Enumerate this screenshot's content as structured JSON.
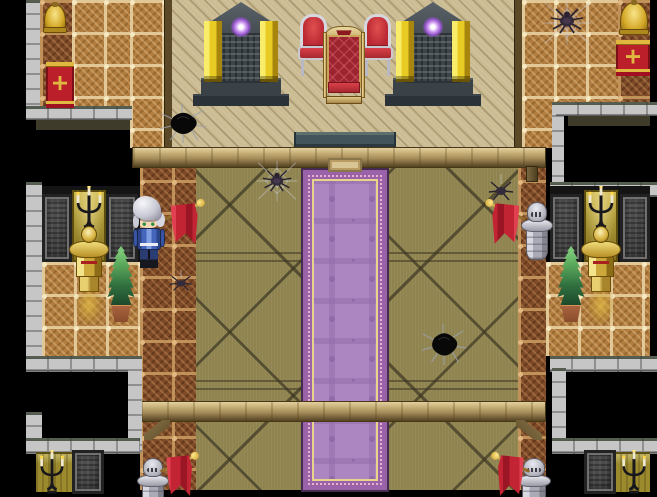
{
  "meta": {
    "viewport": {
      "width": 657,
      "height": 497
    }
  },
  "palette": {
    "void": "#000000",
    "tanFloor": "#cbbc94",
    "tileBase": "#b07c3f",
    "tileFrame": "#e3c897",
    "tileDarkBase": "#7f4a28",
    "tileDarkFrame": "#c1915a",
    "olive": "#8f844f",
    "oliveLine": "#3c3622",
    "stone": "#c6c6c6",
    "stoneLine": "#8f8f8f",
    "stoneTop": "#3d4537",
    "darkbg": "#141414",
    "shadow": "#3f3b2a",
    "oliveWall": "#9c8a2e",
    "carpetField": "#ab86c0",
    "carpetMotif": "#8f6aa8",
    "carpetBand": "#9a62a8",
    "carpetGold": "#e8d48a",
    "carpetEdge": "#452a52",
    "carpetPink": "#e8b2cc",
    "beamFace": "#b89f6a",
    "flagRed": "#c32433",
    "bannerRed": "#bb1f2a",
    "bannerGold": "#e0b840",
    "gold": "#d4b23c",
    "goldLight": "#f5e58a",
    "goldDark": "#8a6a14",
    "silver": "#b9b9c4",
    "silverLight": "#e9e9f0",
    "silverDark": "#6e6e7a",
    "orb": "#cf9af4",
    "plantLight": "#5fae5f",
    "plantDark": "#1d4a2c",
    "pot": "#a9633f",
    "skin": "#f8d8b4",
    "stepTeal": "#43555a",
    "uniformBlue": "#3b5bb0"
  },
  "entities": [
    {
      "type": "goldpanel",
      "name": "lit-alcove-mid-left",
      "x": 72,
      "y": 190,
      "w": 34,
      "h": 72
    },
    {
      "type": "goldpanel",
      "name": "lit-alcove-mid-right",
      "x": 584,
      "y": 190,
      "w": 34,
      "h": 72
    },
    {
      "type": "panel",
      "name": "carved-panel-mid-left-1",
      "x": 42,
      "y": 194,
      "w": 30,
      "h": 68
    },
    {
      "type": "panel",
      "name": "carved-panel-mid-left-2",
      "x": 106,
      "y": 194,
      "w": 32,
      "h": 68
    },
    {
      "type": "panel",
      "name": "carved-panel-mid-right-1",
      "x": 550,
      "y": 194,
      "w": 32,
      "h": 68
    },
    {
      "type": "panel",
      "name": "carved-panel-mid-right-2",
      "x": 620,
      "y": 194,
      "w": 30,
      "h": 68
    },
    {
      "type": "panel",
      "name": "carved-panel-bottom-left",
      "x": 72,
      "y": 450,
      "w": 32,
      "h": 44
    },
    {
      "type": "panel",
      "name": "carved-panel-bottom-right",
      "x": 584,
      "y": 450,
      "w": 32,
      "h": 44
    },
    {
      "type": "candelabra",
      "name": "candelabra-mid-left",
      "x": 72,
      "y": 186,
      "w": 34,
      "h": 48
    },
    {
      "type": "candelabra",
      "name": "candelabra-mid-right",
      "x": 584,
      "y": 186,
      "w": 34,
      "h": 48
    },
    {
      "type": "candelabra",
      "name": "candelabra-bottom-left",
      "x": 36,
      "y": 450,
      "w": 32,
      "h": 46
    },
    {
      "type": "candelabra",
      "name": "candelabra-bottom-right",
      "x": 618,
      "y": 450,
      "w": 32,
      "h": 46
    },
    {
      "type": "goldstatue",
      "name": "gold-armor-statue-left",
      "x": 69,
      "y": 226,
      "w": 40,
      "h": 66
    },
    {
      "type": "goldstatue",
      "name": "gold-armor-statue-right",
      "x": 581,
      "y": 226,
      "w": 40,
      "h": 66
    },
    {
      "type": "goldglow",
      "name": "gold-statue-reflection-left",
      "x": 76,
      "y": 292,
      "w": 26,
      "h": 32
    },
    {
      "type": "goldglow",
      "name": "gold-statue-reflection-right",
      "x": 588,
      "y": 292,
      "w": 26,
      "h": 32
    },
    {
      "type": "plant",
      "name": "potted-plant-left",
      "x": 103,
      "y": 246,
      "w": 36,
      "h": 76
    },
    {
      "type": "plant",
      "name": "potted-plant-right",
      "x": 553,
      "y": 246,
      "w": 36,
      "h": 76
    },
    {
      "type": "bell",
      "name": "gold-bell-top-left",
      "x": 44,
      "y": 4,
      "w": 22,
      "h": 28
    },
    {
      "type": "bell",
      "name": "gold-bell-top-right",
      "x": 620,
      "y": 2,
      "w": 28,
      "h": 32
    },
    {
      "type": "banner",
      "name": "red-banner-top-left",
      "x": 46,
      "y": 62,
      "w": 28,
      "h": 46
    },
    {
      "type": "banner",
      "name": "red-banner-top-right",
      "x": 616,
      "y": 40,
      "w": 34,
      "h": 36
    },
    {
      "type": "monument",
      "name": "shrine-monument-left",
      "x": 188,
      "y": 2,
      "w": 106,
      "h": 104
    },
    {
      "type": "monument",
      "name": "shrine-monument-right",
      "x": 380,
      "y": 2,
      "w": 106,
      "h": 104
    },
    {
      "type": "chair",
      "name": "side-chair-left",
      "x": 298,
      "y": 14,
      "w": 31,
      "h": 62
    },
    {
      "type": "chair",
      "name": "side-chair-right",
      "x": 362,
      "y": 14,
      "w": 31,
      "h": 62
    },
    {
      "type": "throne",
      "name": "royal-throne",
      "x": 322,
      "y": 26,
      "w": 44,
      "h": 78
    },
    {
      "type": "hole",
      "name": "floor-hole-top-left",
      "x": 158,
      "y": 102,
      "w": 50,
      "h": 42
    },
    {
      "type": "hole",
      "name": "floor-hole-center",
      "x": 420,
      "y": 322,
      "w": 48,
      "h": 44
    },
    {
      "type": "web",
      "name": "spider-web-top-right",
      "x": 540,
      "y": 0,
      "w": 54,
      "h": 46
    },
    {
      "type": "spider",
      "name": "spider-top-right",
      "x": 549,
      "y": 6,
      "w": 36,
      "h": 28
    },
    {
      "type": "web",
      "name": "spider-web-mid-left",
      "x": 254,
      "y": 160,
      "w": 46,
      "h": 42
    },
    {
      "type": "spider",
      "name": "spider-mid-left",
      "x": 261,
      "y": 168,
      "w": 32,
      "h": 24
    },
    {
      "type": "spiderhang",
      "name": "spider-hanging-mid-right",
      "x": 487,
      "y": 174,
      "w": 28,
      "h": 28
    },
    {
      "type": "spiderhang",
      "name": "spider-small-left",
      "x": 168,
      "y": 270,
      "w": 26,
      "h": 22
    },
    {
      "type": "knight",
      "name": "silver-armor-statue-mid-right",
      "x": 521,
      "y": 202,
      "w": 32,
      "h": 58
    },
    {
      "type": "knight",
      "name": "silver-armor-statue-bottom-left",
      "x": 137,
      "y": 458,
      "w": 32,
      "h": 56
    },
    {
      "type": "knight",
      "name": "silver-armor-statue-bottom-right",
      "x": 517,
      "y": 458,
      "w": 34,
      "h": 56
    },
    {
      "type": "flag",
      "name": "red-flag-mid-left",
      "x": 164,
      "y": 196,
      "w": 42,
      "h": 52
    },
    {
      "type": "flag",
      "name": "red-flag-mid-right",
      "x": 484,
      "y": 196,
      "w": 42,
      "h": 52,
      "flip": true
    },
    {
      "type": "flag",
      "name": "red-flag-bottom-left",
      "x": 160,
      "y": 448,
      "w": 40,
      "h": 52
    },
    {
      "type": "flag",
      "name": "red-flag-bottom-right",
      "x": 490,
      "y": 448,
      "w": 40,
      "h": 52,
      "flip": true
    },
    {
      "type": "support",
      "name": "beam-post-right",
      "x": 526,
      "y": 166,
      "w": 12,
      "h": 16
    },
    {
      "type": "brace",
      "name": "beam-brace-bottom-left",
      "x": 144,
      "y": 420,
      "w": 26,
      "h": 20
    },
    {
      "type": "brace",
      "name": "beam-brace-bottom-right",
      "x": 516,
      "y": 420,
      "w": 26,
      "h": 20,
      "flip": true
    },
    {
      "type": "hero",
      "name": "player-character",
      "x": 132,
      "y": 196,
      "w": 34,
      "h": 72,
      "interactable": true
    }
  ]
}
